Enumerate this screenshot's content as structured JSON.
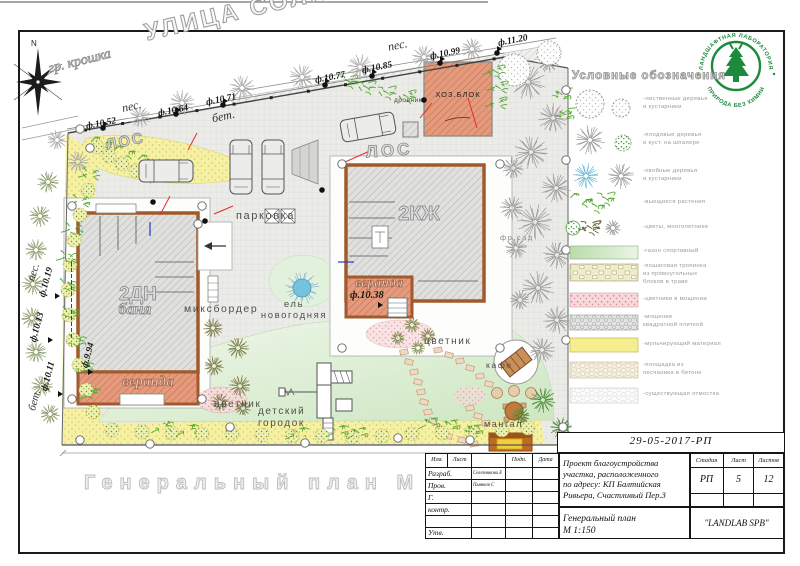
{
  "sheet": {
    "caption": "Генеральный план М 1:150 А3",
    "compass_north": "N"
  },
  "plan": {
    "street_name": "УЛИЦА СОЛНЕ",
    "surfaces": {
      "gravel": "гр. крошка",
      "sand_top": "пес.",
      "sand_mid": "пес.",
      "sand_left": "пес.",
      "concrete_top": "бет.",
      "concrete_left": "бет."
    },
    "elevations": {
      "fence": [
        "ф.10.52",
        "ф.10.64",
        "ф.10.71",
        "ф.10.77",
        "ф.10.85",
        "ф.10.99",
        "ф.11.20"
      ],
      "left": [
        "ф.10.19",
        "ф.10.13",
        "ф.10.11"
      ],
      "bathhouse": "ф.9.94",
      "house": "ф.10.38"
    },
    "buildings": {
      "bathhouse_type": "2ДН",
      "bathhouse_name": "баня",
      "house_type": "2КЖ",
      "utility_block": "ХОЗ.БЛОК",
      "woodshed": "дровник",
      "veranda_bath": "веранда",
      "veranda_house": "веранда",
      "septic_top": "ЛОС",
      "septic_house": "ЛОС"
    },
    "features": {
      "parking": "парковка",
      "mixborder": "миксбордер",
      "spruce": "ель\nновогодняя",
      "flowerbed_bath": "цветник",
      "flowerbed_house": "цветник",
      "playground": "детский\nгородок",
      "cafe": "кафе",
      "bbq": "мангал",
      "fruit_garden": "фр.сад"
    }
  },
  "legend": {
    "title": "Условные обозначения",
    "items": [
      {
        "label": "-лиственные деревья\nи кустарники"
      },
      {
        "label": "-плодовые деревья\nи куст. на шпалере"
      },
      {
        "label": "-хвойные деревья\nи кустарники"
      },
      {
        "label": "-вьющиеся растения"
      },
      {
        "label": "-цветы, многолетники"
      },
      {
        "label": "-газон спортивный"
      },
      {
        "label": "-пошаговая тропинка\nиз прямоугольных\nблоков в траве"
      },
      {
        "label": "-цветники в мощении"
      },
      {
        "label": "-мощение\nквадратной плиткой"
      },
      {
        "label": "-мульчирующий материал"
      },
      {
        "label": "-площадка из\nпесчаника в бетоне"
      },
      {
        "label": "-существующая отмостка"
      }
    ]
  },
  "logo": {
    "arc_top": "ЛАНДШАФТНАЯ ЛАБОРАТОРИЯ",
    "arc_bottom": "ПРИРОДА БЕЗ ХИМИИ"
  },
  "title_block": {
    "doc_number": "29-05-2017-РП",
    "header_cols": {
      "izm": "Изм.",
      "list": "Лист",
      "podp": "Подп.",
      "data": "Дата"
    },
    "rows": [
      {
        "role": "Разраб.",
        "name": "Селезникова Е"
      },
      {
        "role": "Пров.",
        "name": "Пьянков С"
      },
      {
        "role": "Г.",
        "name": ""
      },
      {
        "role": "контр.",
        "name": ""
      },
      {
        "role": "Утв.",
        "name": ""
      }
    ],
    "project_text": "Проект благоустройства\nучастка, расположенного\nпо адресу: КП Балтийская\nРивьера, Счастливый Пер.3",
    "stage": {
      "header": [
        "Стадия",
        "Лист",
        "Листов"
      ],
      "values": [
        "РП",
        "5",
        "12"
      ]
    },
    "drawing_title": "Генеральный план\nМ 1:150",
    "company": "\"LANDLAB SPB\""
  }
}
